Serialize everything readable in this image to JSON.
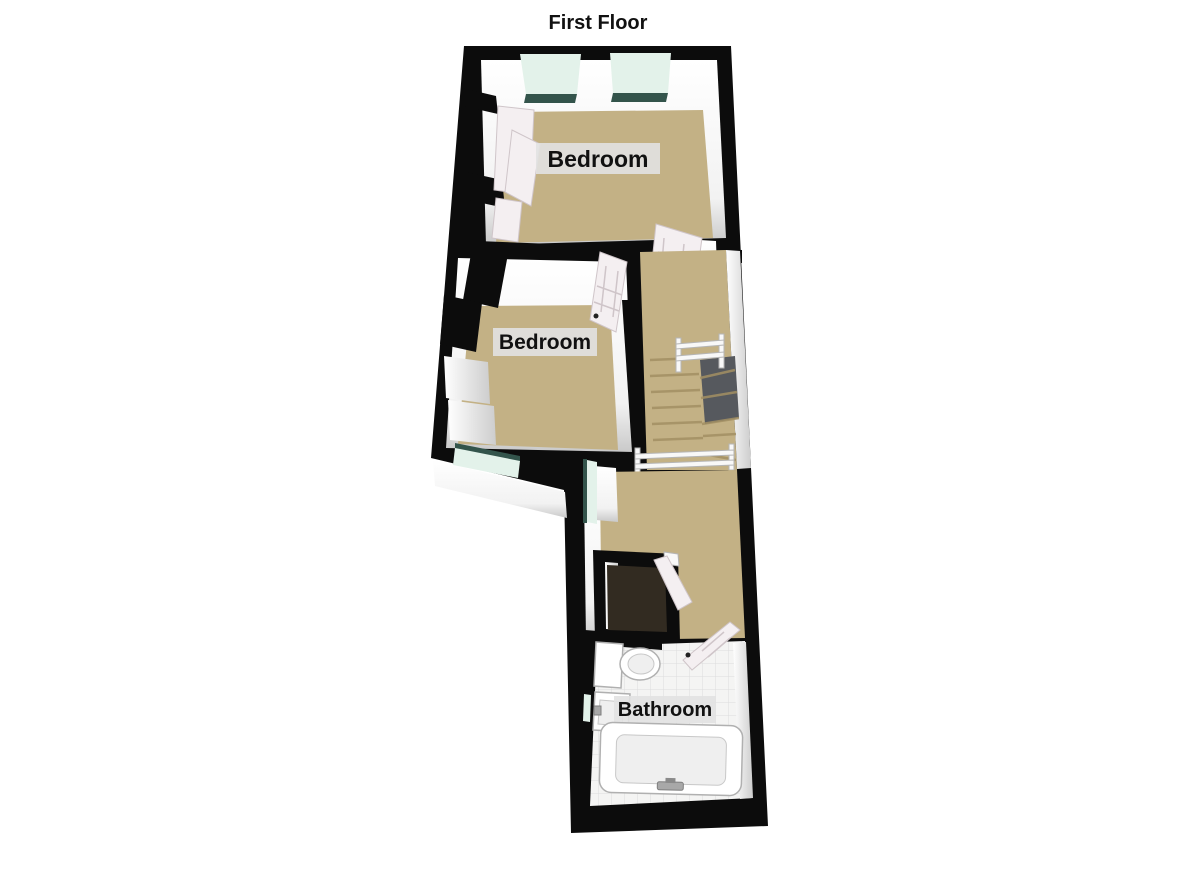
{
  "title": "First Floor",
  "rooms": [
    {
      "id": "bedroom-1",
      "label": "Bedroom"
    },
    {
      "id": "bedroom-2",
      "label": "Bedroom"
    },
    {
      "id": "bathroom",
      "label": "Bathroom"
    }
  ],
  "colors": {
    "wall": "#0c0c0c",
    "carpet": "#c3b185",
    "carpet_edge": "#a28f63",
    "glass": "#e3f2ea",
    "glass_edge": "#33544b",
    "tile": "#f4f4f3",
    "tile_line": "#dcdcdc",
    "stairwell": "#56595e",
    "cupboard_floor": "#322b21",
    "door": "#f4eff1",
    "door_line": "#cfc5c9",
    "label_bg": "#e2e2e2",
    "text": "#111111"
  }
}
